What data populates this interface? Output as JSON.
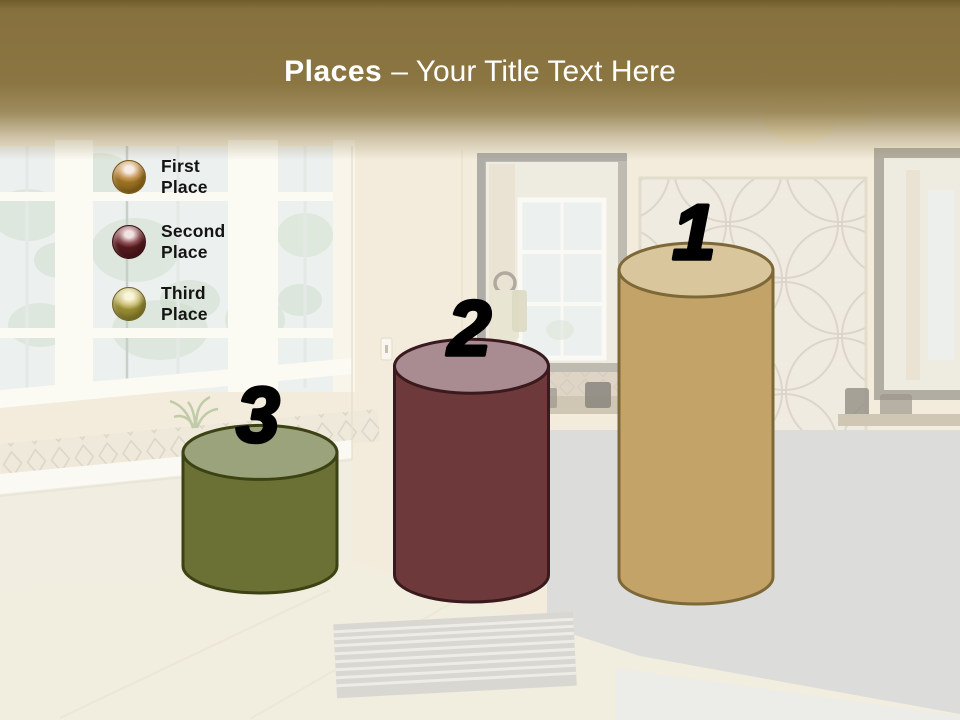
{
  "slide": {
    "title_bold": "Places",
    "title_rest": "– Your Title Text Here",
    "band_color": "#8a7541",
    "title_color": "#ffffff"
  },
  "legend": {
    "items": [
      {
        "label": "First Place",
        "sphere": {
          "highlight": "#f7ece4",
          "mid": "#c89a5c",
          "dark": "#9a701f",
          "rim": "#7a581b"
        }
      },
      {
        "label": "Second Place",
        "sphere": {
          "highlight": "#f2e2e1",
          "mid": "#8f5458",
          "dark": "#54191d",
          "rim": "#3c1013"
        }
      },
      {
        "label": "Third Place",
        "sphere": {
          "highlight": "#f9f5d9",
          "mid": "#cfc37e",
          "dark": "#968a31",
          "rim": "#6e6521"
        }
      }
    ]
  },
  "chart_data": {
    "type": "bar",
    "variant": "3d-cylinder-podium",
    "title": "Places",
    "categories": [
      "Third Place",
      "Second Place",
      "First Place"
    ],
    "values": [
      3,
      2,
      1
    ],
    "relative_heights": [
      0.37,
      0.68,
      1.0
    ],
    "legend_position": "upper-left",
    "number_color": "#000000",
    "bars": [
      {
        "rank": "3",
        "name": "Third Place",
        "relative_height": 0.37,
        "body_color": "#6b7135",
        "top_color": "#9aa37b",
        "outline_color": "#3c4214"
      },
      {
        "rank": "2",
        "name": "Second Place",
        "relative_height": 0.68,
        "body_color": "#6e393a",
        "top_color": "#a98b92",
        "outline_color": "#3a1a1e"
      },
      {
        "rank": "1",
        "name": "First Place",
        "relative_height": 1.0,
        "body_color": "#c3a368",
        "top_color": "#d9c69c",
        "outline_color": "#7d6838"
      }
    ]
  }
}
